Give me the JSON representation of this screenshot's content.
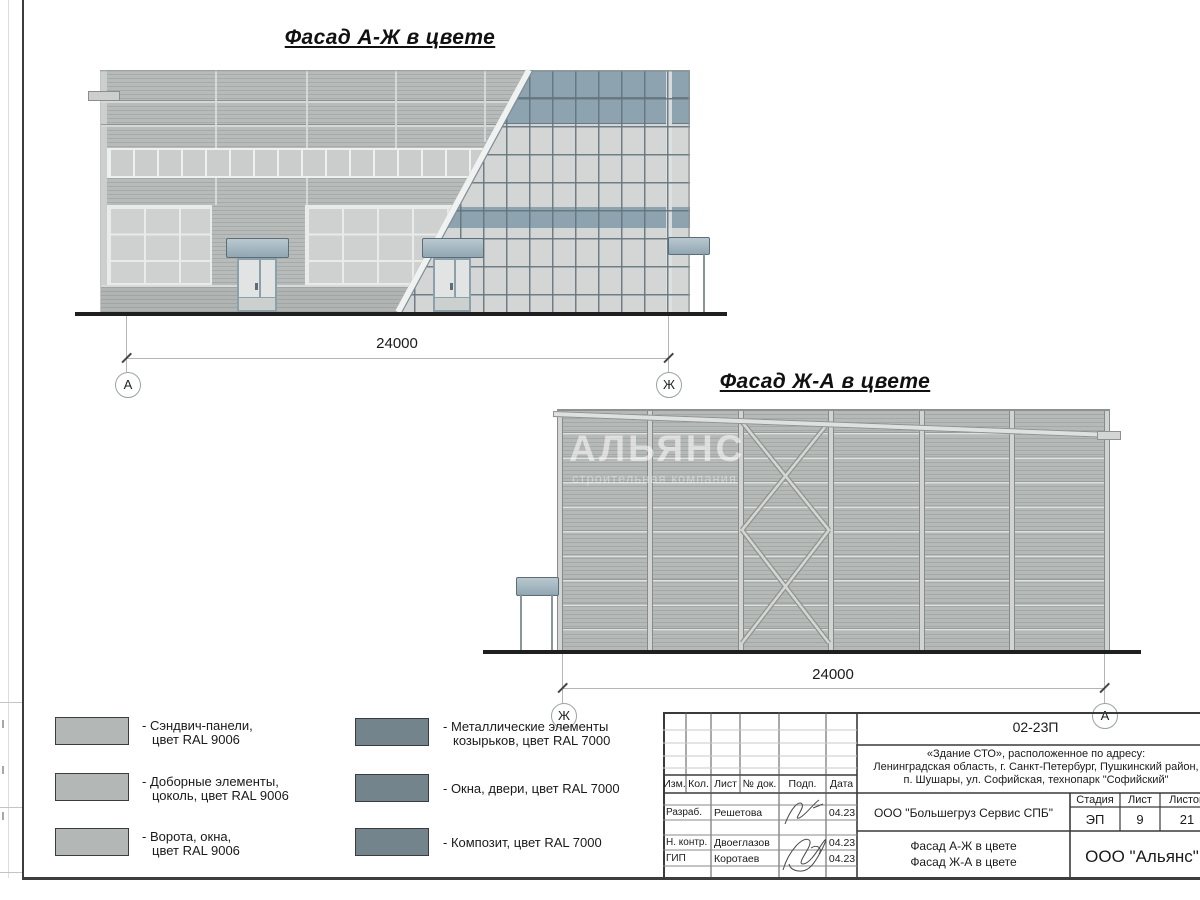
{
  "facade1": {
    "title": "Фасад А-Ж в цвете",
    "dimension": "24000",
    "axis_left": "А",
    "axis_right": "Ж"
  },
  "facade2": {
    "title": "Фасад Ж-А в цвете",
    "dimension": "24000",
    "axis_left": "Ж",
    "axis_right": "А",
    "watermark_line1": "АЛЬЯНС",
    "watermark_line2": "строительная компания"
  },
  "legend": {
    "items": [
      {
        "color_name": "RAL 9006",
        "swatch_hex": "#b3b7b5",
        "lines": [
          "- Сэндвич-панели,",
          "цвет RAL 9006"
        ]
      },
      {
        "color_name": "RAL 9006",
        "swatch_hex": "#b3b7b5",
        "lines": [
          "- Доборные элементы,",
          "цоколь, цвет RAL 9006"
        ]
      },
      {
        "color_name": "RAL 9006",
        "swatch_hex": "#b3b7b5",
        "lines": [
          "- Ворота, окна,",
          "цвет RAL 9006"
        ]
      },
      {
        "color_name": "RAL 7000",
        "swatch_hex": "#73848d",
        "lines": [
          "- Металлические элементы",
          "козырьков, цвет RAL 7000"
        ]
      },
      {
        "color_name": "RAL 7000",
        "swatch_hex": "#73848d",
        "lines": [
          "- Окна, двери, цвет RAL 7000"
        ]
      },
      {
        "color_name": "RAL 7000",
        "swatch_hex": "#73848d",
        "lines": [
          "- Композит, цвет RAL 7000"
        ]
      }
    ]
  },
  "title_block": {
    "doc_number": "02-23П",
    "project_lines": [
      "«Здание СТО», расположенное по адресу:",
      "Ленинградская область, г. Санкт-Петербург, Пушкинский район,",
      "п. Шушары, ул. Софийская, технопарк \"Софийский\""
    ],
    "header_cols": [
      "Изм.",
      "Кол.",
      "Лист",
      "№ док.",
      "Подп.",
      "Дата"
    ],
    "rows": [
      {
        "role": "Разраб.",
        "name": "Решетова",
        "date": "04.23"
      },
      {
        "role": "Н. контр.",
        "name": "Двоеглазов",
        "date": "04.23"
      },
      {
        "role": "ГИП",
        "name": "Коротаев",
        "date": "04.23"
      }
    ],
    "client": "ООО \"Большегруз Сервис СПБ\"",
    "sheet_title_lines": [
      "Фасад А-Ж в цвете",
      "Фасад Ж-А в цвете"
    ],
    "stage_label": "Стадия",
    "sheet_label": "Лист",
    "sheets_label": "Листов",
    "stage": "ЭП",
    "sheet_no": "9",
    "sheets_total": "21",
    "company": "ООО \"Альянс\""
  },
  "colors": {
    "panel_gray": "#b6bab8",
    "glazing": "#d4d6d5",
    "band_blue": "#8da3af",
    "canopy_blue": "#a5b8c2",
    "legend_swatch_gray": "#b3b7b5",
    "legend_swatch_blue": "#73848d"
  }
}
